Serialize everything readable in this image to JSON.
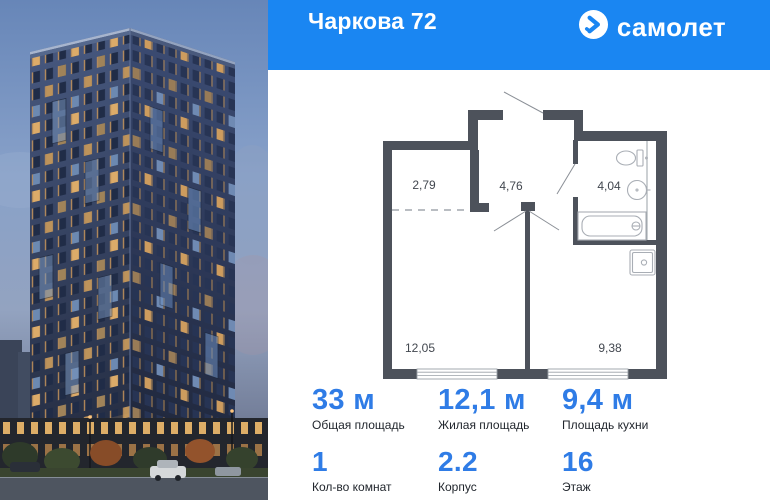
{
  "header": {
    "title": "Чаркова 72",
    "brand": "самолет",
    "logo_icon": "samolet-arrow-icon",
    "bg_color": "#1a86f2"
  },
  "plan": {
    "wall_color": "#4d525b",
    "rooms": [
      "2,79",
      "4,76",
      "4,04",
      "12,05",
      "9,38"
    ]
  },
  "stats": {
    "accent_color": "#2f7ce6",
    "row1": [
      {
        "value": "33 м",
        "label": "Общая площадь"
      },
      {
        "value": "12,1 м",
        "label": "Жилая площадь"
      },
      {
        "value": "9,4 м",
        "label": "Площадь кухни"
      }
    ],
    "row2": [
      {
        "value": "1",
        "label": "Кол-во комнат"
      },
      {
        "value": "2.2",
        "label": "Корпус"
      },
      {
        "value": "16",
        "label": "Этаж"
      }
    ]
  }
}
